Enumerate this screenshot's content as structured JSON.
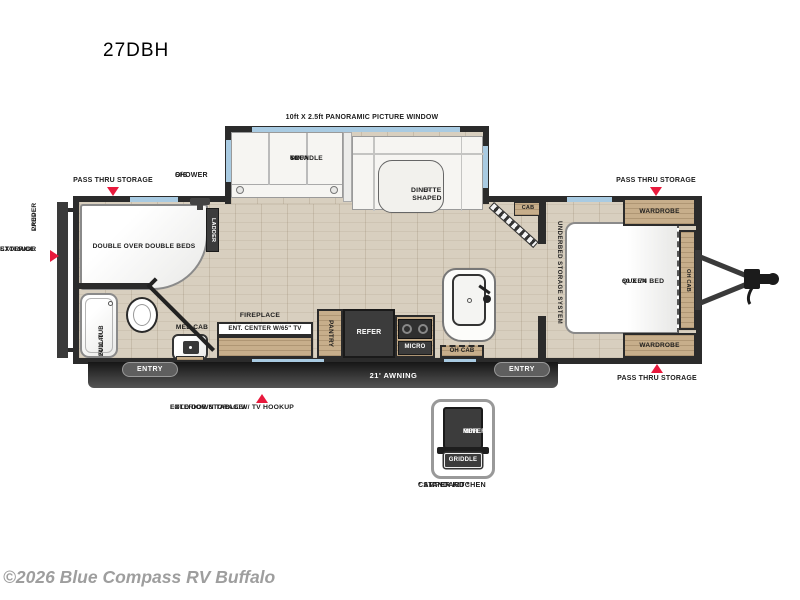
{
  "meta": {
    "model": "27DBH",
    "copyright": "©2026 Blue Compass RV Buffalo"
  },
  "colors": {
    "arrow_red": "#e8193c",
    "wall": "#2b2b2b",
    "window_blue": "#a9cbe2",
    "floor_wood": "#d8cfbf",
    "cabinet_tan": "#c7ae8b",
    "appliance_dark": "#3c3c3c",
    "copyright_gray": "#9e9e9e"
  },
  "labels": {
    "picture_window": "10ft X 2.5ft PANORAMIC PICTURE WINDOW",
    "trundle_sofa_1": "60\"",
    "trundle_sofa_2": "TRUNDLE",
    "trundle_sofa_3": "SOFA",
    "dinette_1": "U-SHAPED",
    "dinette_2": "DINETTE",
    "pass_thru_storage": "PASS THRU STORAGE",
    "os_shower_1": "O/S",
    "os_shower_2": "SHOWER",
    "ladder_prep_1": "LADDER",
    "ladder_prep_2": "PREP",
    "bunk_ladder": "LADDER",
    "double_beds": "DOUBLE OVER DOUBLE BEDS",
    "exterior_storage_1": "EXTERIOR",
    "exterior_storage_2": "STORAGE",
    "tub_1": "24 X 40",
    "tub_2": "FULL TUB",
    "med_cab": "MED CAB",
    "fireplace": "FIREPLACE",
    "ent_center": "ENT. CENTER W/65\" TV",
    "pantry": "PANTRY",
    "refer": "REFER",
    "micro": "MICRO",
    "oh_cab": "OH CAB",
    "cab": "CAB",
    "underbed": "UNDERBED STORAGE SYSTEM",
    "queen_bed_1": "QUEEN BED",
    "queen_bed_2": "60 X 74",
    "wardrobe": "WARDROBE",
    "awning": "21' AWNING",
    "entry": "ENTRY",
    "fold_down_1": "EXTERIOR STORAGE/",
    "fold_down_2": "FOLD DOWN TABLE W/ TV HOOKUP",
    "mini_refer_1": "MINI",
    "mini_refer_2": "REFER",
    "griddle": "GRIDDLE",
    "camper_kitchen_1": "* STANDARD *",
    "camper_kitchen_2": "CAMPER KITCHEN"
  }
}
